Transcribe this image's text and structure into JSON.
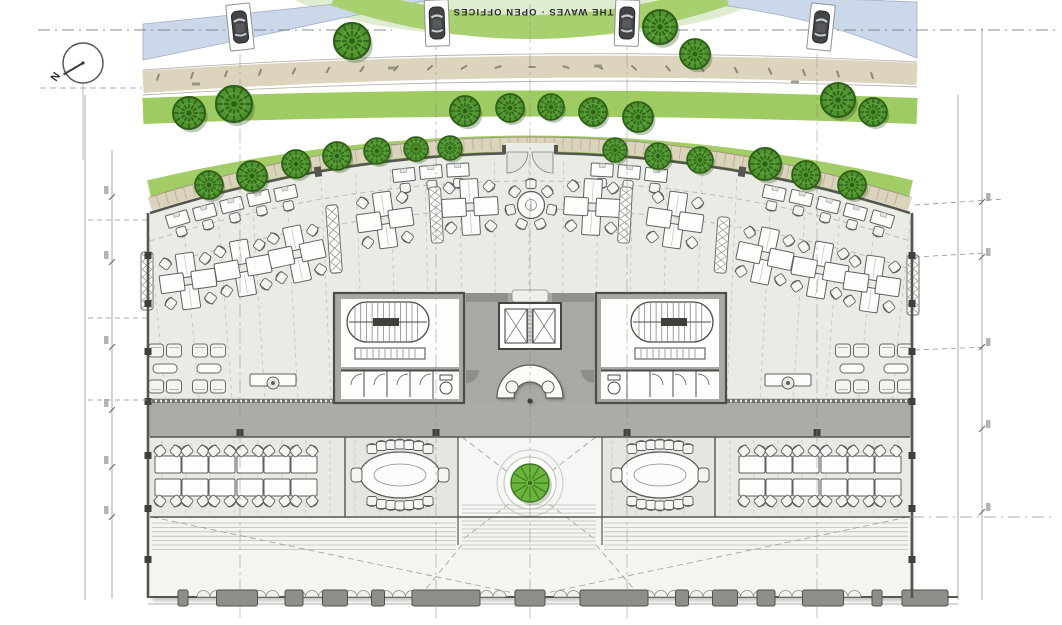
{
  "title": {
    "text": "THE WAVES · OPEN OFFICES"
  },
  "north": {
    "label": "N"
  },
  "palette": {
    "water": "#cbd8e9",
    "road": "#ddd4be",
    "lawn_pale": "#e0ecd0",
    "grass": "#a2cd66",
    "grass_bright": "#8fc353",
    "tree": "#4f9431",
    "tree_dark": "#2c5f15",
    "tree_big": "#6cb43c",
    "floor": "#e9ebe5",
    "wall": "#55564f",
    "core_gray": "#a9a9a3",
    "furniture_line": "#5f615f"
  },
  "plan": {
    "trees": [
      [
        189,
        113,
        16
      ],
      [
        234,
        104,
        18
      ],
      [
        352,
        41,
        18
      ],
      [
        660,
        27,
        17
      ],
      [
        695,
        54,
        15
      ],
      [
        838,
        100,
        17
      ],
      [
        873,
        112,
        14
      ],
      [
        465,
        111,
        15
      ],
      [
        510,
        108,
        14
      ],
      [
        551,
        107,
        13
      ],
      [
        593,
        112,
        14
      ],
      [
        638,
        117,
        15
      ],
      [
        209,
        185,
        14
      ],
      [
        252,
        176,
        15
      ],
      [
        296,
        164,
        14
      ],
      [
        337,
        156,
        14
      ],
      [
        377,
        151,
        13
      ],
      [
        416,
        149,
        12
      ],
      [
        450,
        148,
        12
      ],
      [
        615,
        150,
        12
      ],
      [
        658,
        156,
        13
      ],
      [
        700,
        160,
        13
      ],
      [
        765,
        164,
        16
      ],
      [
        806,
        175,
        14
      ],
      [
        852,
        185,
        14
      ]
    ],
    "courtyard_tree": [
      530,
      483,
      19
    ],
    "cars": [
      [
        240,
        27,
        -6
      ],
      [
        437,
        23,
        -2
      ],
      [
        627,
        23,
        2
      ],
      [
        821,
        27,
        6
      ]
    ],
    "wall_desks": [
      [
        178,
        220,
        -17
      ],
      [
        205,
        213,
        -15
      ],
      [
        232,
        206,
        -14
      ],
      [
        259,
        199,
        -13
      ],
      [
        286,
        194,
        -12
      ],
      [
        404,
        176,
        -6
      ],
      [
        431,
        173,
        -5
      ],
      [
        458,
        171,
        -3
      ],
      [
        602,
        171,
        3
      ],
      [
        629,
        173,
        5
      ],
      [
        656,
        176,
        6
      ],
      [
        774,
        194,
        12
      ],
      [
        801,
        199,
        13
      ],
      [
        828,
        206,
        14
      ],
      [
        855,
        213,
        15
      ],
      [
        882,
        220,
        17
      ]
    ],
    "quad_clusters": [
      [
        188,
        281,
        -8
      ],
      [
        243,
        268,
        -10
      ],
      [
        297,
        254,
        -12
      ],
      [
        385,
        220,
        -8
      ],
      [
        470,
        207,
        -3
      ],
      [
        592,
        207,
        3
      ],
      [
        675,
        220,
        8
      ],
      [
        765,
        256,
        12
      ],
      [
        820,
        270,
        10
      ],
      [
        872,
        284,
        8
      ]
    ],
    "round_table": [
      531,
      205
    ],
    "planters": [
      [
        147,
        281,
        58,
        0
      ],
      [
        334,
        239,
        68,
        -4
      ],
      [
        436,
        215,
        56,
        -3
      ],
      [
        625,
        215,
        56,
        3
      ],
      [
        722,
        245,
        56,
        4
      ],
      [
        913,
        285,
        60,
        0
      ],
      [
        332,
        484,
        50,
        0
      ],
      [
        728,
        486,
        56,
        0
      ]
    ],
    "sofa_groups": [
      [
        165,
        369
      ],
      [
        209,
        369
      ],
      [
        852,
        369
      ],
      [
        896,
        369
      ]
    ],
    "lounge_desks": [
      [
        273,
        380
      ],
      [
        788,
        380
      ]
    ],
    "bench_clusters": [
      [
        168,
        476
      ],
      [
        195,
        476
      ],
      [
        222,
        476
      ],
      [
        250,
        476
      ],
      [
        277,
        476
      ],
      [
        304,
        476
      ],
      [
        752,
        476
      ],
      [
        779,
        476
      ],
      [
        806,
        476
      ],
      [
        834,
        476
      ],
      [
        861,
        476
      ],
      [
        888,
        476
      ]
    ],
    "conference_tables": [
      [
        400,
        475
      ],
      [
        660,
        475
      ]
    ],
    "facade_blocks": [
      [
        183,
        10
      ],
      [
        237,
        41
      ],
      [
        294,
        18
      ],
      [
        335,
        25
      ],
      [
        378,
        13
      ],
      [
        446,
        68
      ],
      [
        530,
        30
      ],
      [
        614,
        68
      ],
      [
        682,
        13
      ],
      [
        725,
        25
      ],
      [
        766,
        18
      ],
      [
        823,
        41
      ],
      [
        877,
        10
      ],
      [
        925,
        46
      ]
    ],
    "scallop_groups": [
      [
        210,
        2
      ],
      [
        266,
        2
      ],
      [
        312,
        3
      ],
      [
        357,
        2
      ],
      [
        399,
        3
      ],
      [
        493,
        2
      ],
      [
        567,
        2
      ],
      [
        661,
        3
      ],
      [
        703,
        2
      ],
      [
        747,
        3
      ],
      [
        792,
        2
      ],
      [
        848,
        2
      ]
    ],
    "grid_x": [
      240,
      436,
      530,
      627,
      817
    ],
    "dim_ticks_left": [
      197,
      262,
      347,
      410,
      467,
      517
    ],
    "dim_ticks_right": [
      202,
      257,
      347,
      429,
      512
    ],
    "road_labels": [
      [
        196,
        84
      ],
      [
        392,
        68
      ],
      [
        598,
        66
      ],
      [
        795,
        82
      ]
    ]
  }
}
